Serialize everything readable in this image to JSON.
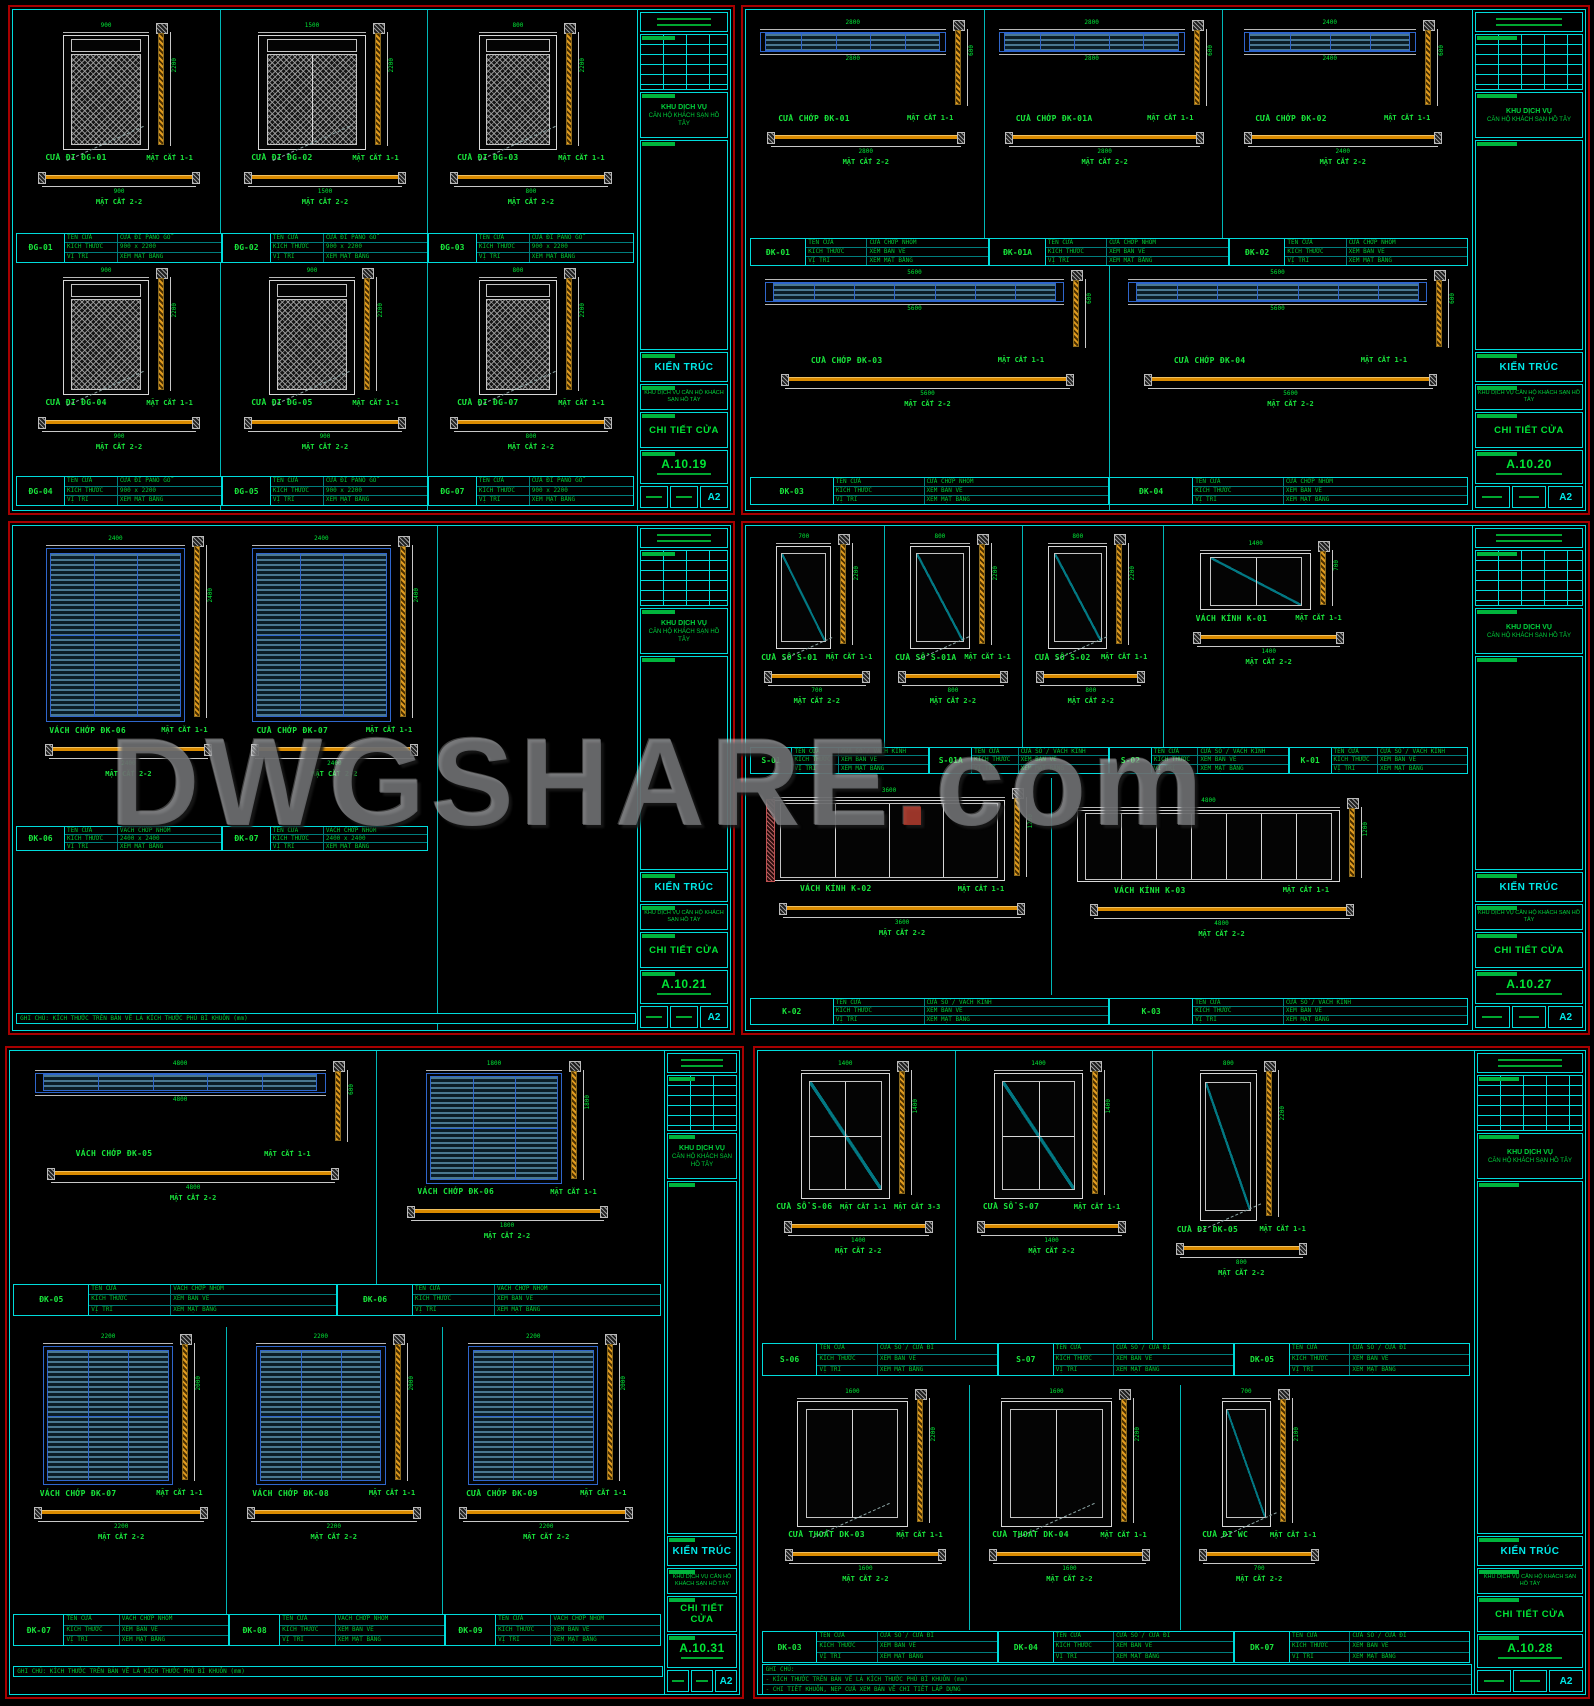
{
  "watermark": {
    "main": "DWGSHARE",
    "dot": ".",
    "tld": "com"
  },
  "labels": {
    "cut1": "MẶT CẮT 1-1",
    "cut2": "MẶT CẮT 2-2"
  },
  "sched_labels": [
    "TÊN CỬA",
    "KÍCH THƯỚC",
    "VỊ TRÍ"
  ],
  "titleblock": {
    "discipline": "KIẾN TRÚC",
    "project_l1": "KHU DỊCH VỤ",
    "project_l2": "CĂN HỘ KHÁCH SẠN HỒ TÂY",
    "project_full": "KHU DỊCH VỤ CĂN HỘ KHÁCH SẠN HỒ TÂY",
    "title": "CHI TIẾT CỬA",
    "paper": "A2"
  },
  "sheets": [
    {
      "sheet_no": "A.10.19",
      "region": {
        "x": 8,
        "y": 5,
        "w": 727,
        "h": 510,
        "tb": 92
      },
      "sched_vals": [
        "CỬA ĐI PANO GỖ",
        "900 x 2200",
        "XEM MẶT BẰNG"
      ],
      "vlines": [
        {
          "x": 33.2
        },
        {
          "x": 66.4
        }
      ],
      "groups": [
        {
          "x": 2,
          "y": 2.5,
          "w": 30,
          "h": 41,
          "kind": "door-hatch",
          "label": "CỬA ĐI ĐG-01",
          "dims": {
            "w": "900",
            "h": "2200"
          },
          "elev_w": 46,
          "draw_h": 62
        },
        {
          "x": 35,
          "y": 2.5,
          "w": 30,
          "h": 41,
          "kind": "door-hatch2",
          "label": "CỬA ĐI ĐG-02",
          "dims": {
            "w": "1500",
            "h": "2200"
          },
          "elev_w": 58,
          "draw_h": 62
        },
        {
          "x": 68,
          "y": 2.5,
          "w": 30,
          "h": 41,
          "kind": "door-hatch",
          "label": "CỬA ĐI ĐG-03",
          "dims": {
            "w": "800",
            "h": "2200"
          },
          "elev_w": 42,
          "draw_h": 62
        },
        {
          "x": 2,
          "y": 51.5,
          "w": 30,
          "h": 41,
          "kind": "door-hatch",
          "label": "CỬA ĐI ĐG-04",
          "dims": {
            "w": "900",
            "h": "2200"
          },
          "elev_w": 46,
          "draw_h": 62
        },
        {
          "x": 35,
          "y": 51.5,
          "w": 30,
          "h": 41,
          "kind": "door-hatch",
          "label": "CỬA ĐI ĐG-05",
          "dims": {
            "w": "900",
            "h": "2200"
          },
          "elev_w": 46,
          "draw_h": 62
        },
        {
          "x": 68,
          "y": 51.5,
          "w": 30,
          "h": 41,
          "kind": "door-hatch",
          "label": "CỬA ĐI ĐG-07",
          "dims": {
            "w": "800",
            "h": "2200"
          },
          "elev_w": 42,
          "draw_h": 62
        }
      ],
      "schedules": [
        {
          "x": 0.5,
          "y": 44.5,
          "w": 99,
          "h": 6,
          "tags": [
            "ĐG-01",
            "ĐG-02",
            "ĐG-03"
          ]
        },
        {
          "x": 0.5,
          "y": 93.2,
          "w": 99,
          "h": 6,
          "tags": [
            "ĐG-04",
            "ĐG-05",
            "ĐG-07"
          ]
        }
      ]
    },
    {
      "sheet_no": "A.10.20",
      "region": {
        "x": 741,
        "y": 5,
        "w": 849,
        "h": 510,
        "tb": 112
      },
      "sched_vals": [
        "CỬA CHỚP NHÔM",
        "XEM BẢN VẼ",
        "XEM MẶT BẰNG"
      ],
      "vlines": [
        {
          "x": 32.8,
          "y2": 50
        },
        {
          "x": 65.6,
          "y2": 50
        },
        {
          "x": 50,
          "y1": 50
        }
      ],
      "groups": [
        {
          "x": 0.5,
          "y": 2,
          "w": 32,
          "h": 43,
          "kind": "louvre-strip",
          "panes": 5,
          "label": "CỬA CHỚP ĐK-01",
          "dims": {
            "w": "2800",
            "h": "600"
          },
          "elev_w": 80,
          "draw_h": 42
        },
        {
          "x": 33.4,
          "y": 2,
          "w": 32,
          "h": 43,
          "kind": "louvre-strip",
          "panes": 5,
          "label": "CỬA CHỚP ĐK-01A",
          "dims": {
            "w": "2800",
            "h": "600"
          },
          "elev_w": 80,
          "draw_h": 42
        },
        {
          "x": 66.2,
          "y": 2,
          "w": 32,
          "h": 43,
          "kind": "louvre-strip",
          "panes": 4,
          "label": "CỬA CHỚP ĐK-02",
          "dims": {
            "w": "2400",
            "h": "600"
          },
          "elev_w": 74,
          "draw_h": 42
        },
        {
          "x": 1,
          "y": 52,
          "w": 48,
          "h": 41,
          "kind": "louvre-strip",
          "panes": 7,
          "label": "CỬA CHỚP ĐK-03",
          "dims": {
            "w": "5600",
            "h": "600"
          },
          "elev_w": 86,
          "draw_h": 40
        },
        {
          "x": 51,
          "y": 52,
          "w": 48,
          "h": 41,
          "kind": "louvre-strip",
          "panes": 7,
          "label": "CỬA CHỚP ĐK-04",
          "dims": {
            "w": "5600",
            "h": "600"
          },
          "elev_w": 86,
          "draw_h": 40
        }
      ],
      "schedules": [
        {
          "x": 0.5,
          "y": 45.6,
          "w": 99,
          "h": 5.6,
          "tags": [
            "ĐK-01",
            "ĐK-01A",
            "ĐK-02"
          ]
        },
        {
          "x": 0.5,
          "y": 93.4,
          "w": 99,
          "h": 5.6,
          "tags": [
            "ĐK-03",
            "ĐK-04"
          ]
        }
      ]
    },
    {
      "sheet_no": "A.10.21",
      "region": {
        "x": 8,
        "y": 521,
        "w": 727,
        "h": 514,
        "tb": 92
      },
      "sched_vals": [
        "VÁCH CHỚP NHÔM",
        "2400 x 2400",
        "XEM MẶT BẰNG"
      ],
      "vlines": [
        {
          "x": 68
        }
      ],
      "groups": [
        {
          "x": 3,
          "y": 2,
          "w": 31,
          "h": 56,
          "kind": "louvre",
          "label": "VÁCH CHỚP ĐK-06",
          "dims": {
            "w": "2400",
            "h": "2400"
          },
          "elev_w": 72,
          "draw_h": 66
        },
        {
          "x": 36,
          "y": 2,
          "w": 31,
          "h": 56,
          "kind": "louvre",
          "label": "CỬA CHỚP ĐK-07",
          "dims": {
            "w": "2400",
            "h": "2400"
          },
          "elev_w": 72,
          "draw_h": 66
        }
      ],
      "schedules": [
        {
          "x": 0.5,
          "y": 59.5,
          "w": 66,
          "h": 5,
          "tags": [
            "ĐK-06",
            "ĐK-07"
          ]
        }
      ],
      "notes": {
        "x": 0.5,
        "y": 96.6,
        "w": 99,
        "lines": [
          "GHI CHÚ: KÍCH THƯỚC TRÊN BẢN VẼ LÀ KÍCH THƯỚC PHỦ BÌ KHUÔN (mm)"
        ]
      }
    },
    {
      "sheet_no": "A.10.27",
      "region": {
        "x": 741,
        "y": 521,
        "w": 849,
        "h": 514,
        "tb": 112
      },
      "sched_vals": [
        "CỬA SỔ / VÁCH KÍNH",
        "XEM BẢN VẼ",
        "XEM MẶT BẰNG"
      ],
      "vlines": [
        {
          "x": 19,
          "y2": 44
        },
        {
          "x": 38,
          "y2": 44
        },
        {
          "x": 57.5,
          "y2": 44
        },
        {
          "x": 42,
          "y1": 50,
          "y2": 93
        }
      ],
      "groups": [
        {
          "x": 1.5,
          "y": 1.5,
          "w": 16.5,
          "h": 41,
          "kind": "door-glass",
          "label": "CỬA SỔ S-01",
          "dims": {
            "w": "700",
            "h": "2200"
          },
          "elev_w": 46,
          "draw_h": 56
        },
        {
          "x": 20,
          "y": 1.5,
          "w": 17,
          "h": 41,
          "kind": "door-glass",
          "label": "CỬA SỔ S-01A",
          "dims": {
            "w": "800",
            "h": "2200"
          },
          "elev_w": 48,
          "draw_h": 56
        },
        {
          "x": 39,
          "y": 1.5,
          "w": 17,
          "h": 41,
          "kind": "door-glass",
          "label": "CỬA SỔ S-02",
          "dims": {
            "w": "800",
            "h": "2200"
          },
          "elev_w": 48,
          "draw_h": 56
        },
        {
          "x": 60,
          "y": 3,
          "w": 24,
          "h": 38,
          "kind": "window-2pane",
          "label": "VÁCH KÍNH K-01",
          "dims": {
            "w": "1400",
            "h": "700"
          },
          "elev_w": 64,
          "draw_h": 36
        },
        {
          "x": 1.5,
          "y": 52,
          "w": 40,
          "h": 40,
          "kind": "glass-multi",
          "panes": 4,
          "endblock": true,
          "label": "VÁCH KÍNH K-02",
          "dims": {
            "w": "3600",
            "h": "1200"
          },
          "elev_w": 80,
          "draw_h": 46
        },
        {
          "x": 44,
          "y": 54,
          "w": 43,
          "h": 38,
          "kind": "glass-multi",
          "panes": 7,
          "label": "VÁCH KÍNH K-03",
          "dims": {
            "w": "4800",
            "h": "1200"
          },
          "elev_w": 84,
          "draw_h": 44
        }
      ],
      "schedules": [
        {
          "x": 0.5,
          "y": 43.8,
          "w": 99,
          "h": 5.4,
          "tags": [
            "S-01",
            "S-01A",
            "S-02",
            "K-01"
          ]
        },
        {
          "x": 0.5,
          "y": 93.6,
          "w": 99,
          "h": 5.4,
          "tags": [
            "K-02",
            "K-03"
          ]
        }
      ]
    },
    {
      "sheet_no": "A.10.31",
      "region": {
        "x": 5,
        "y": 1046,
        "w": 739,
        "h": 653,
        "tb": 74
      },
      "sched_vals": [
        "VÁCH CHỚP NHÔM",
        "XEM BẢN VẼ",
        "XEM MẶT BẰNG"
      ],
      "vlines": [
        {
          "x": 56,
          "y2": 41
        },
        {
          "x": 33,
          "y1": 43,
          "y2": 92
        },
        {
          "x": 66,
          "y1": 43,
          "y2": 92
        }
      ],
      "groups": [
        {
          "x": 1.5,
          "y": 1.5,
          "w": 53,
          "h": 33,
          "kind": "louvre-strip",
          "panes": 5,
          "label": "VÁCH CHỚP ĐK-05",
          "dims": {
            "w": "4800",
            "h": "600"
          },
          "elev_w": 84,
          "draw_h": 40
        },
        {
          "x": 58,
          "y": 1.5,
          "w": 36,
          "h": 33,
          "kind": "louvre",
          "label": "VÁCH CHỚP ĐK-06",
          "dims": {
            "w": "1800",
            "h": "1800"
          },
          "elev_w": 58,
          "draw_h": 58
        },
        {
          "x": 1.5,
          "y": 44,
          "w": 31,
          "h": 42,
          "kind": "louvre",
          "label": "VÁCH CHỚP ĐK-07",
          "dims": {
            "w": "2200",
            "h": "2000"
          },
          "elev_w": 64,
          "draw_h": 56
        },
        {
          "x": 34,
          "y": 44,
          "w": 31,
          "h": 42,
          "kind": "louvre",
          "label": "VÁCH CHỚP ĐK-08",
          "dims": {
            "w": "2200",
            "h": "2000"
          },
          "elev_w": 64,
          "draw_h": 56
        },
        {
          "x": 66.5,
          "y": 44,
          "w": 31,
          "h": 42,
          "kind": "louvre",
          "label": "CỬA CHỚP ĐK-09",
          "dims": {
            "w": "2200",
            "h": "2000"
          },
          "elev_w": 64,
          "draw_h": 56
        }
      ],
      "schedules": [
        {
          "x": 0.5,
          "y": 36.2,
          "w": 99,
          "h": 5,
          "tags": [
            "ĐK-05",
            "ĐK-06"
          ]
        },
        {
          "x": 0.5,
          "y": 87.6,
          "w": 99,
          "h": 5,
          "tags": [
            "ĐK-07",
            "ĐK-08",
            "ĐK-09"
          ]
        }
      ],
      "notes": {
        "x": 0.5,
        "y": 95.6,
        "w": 99,
        "lines": [
          "GHI CHÚ: KÍCH THƯỚC TRÊN BẢN VẼ LÀ KÍCH THƯỚC PHỦ BÌ KHUÔN (mm)"
        ]
      }
    },
    {
      "sheet_no": "A.10.28",
      "region": {
        "x": 753,
        "y": 1046,
        "w": 837,
        "h": 653,
        "tb": 110
      },
      "sched_vals": [
        "CỬA SỔ / CỬA ĐI",
        "XEM BẢN VẼ",
        "XEM MẶT BẰNG"
      ],
      "vlines": [
        {
          "x": 27.5,
          "y2": 45
        },
        {
          "x": 55,
          "y2": 45
        },
        {
          "x": 29.5,
          "y1": 52,
          "y2": 90
        },
        {
          "x": 59,
          "y1": 52,
          "y2": 90
        }
      ],
      "groups": [
        {
          "x": 2,
          "y": 1.5,
          "w": 24,
          "h": 43,
          "kind": "window-4pane",
          "label": "CỬA SỔ S-06",
          "cut3": "MẶT CẮT 3-3",
          "dims": {
            "w": "1400",
            "h": "1400"
          },
          "elev_w": 52,
          "draw_h": 50
        },
        {
          "x": 29,
          "y": 1.5,
          "w": 24,
          "h": 43,
          "kind": "window-4pane",
          "label": "CỬA SỔ S-07",
          "dims": {
            "w": "1400",
            "h": "1400"
          },
          "elev_w": 52,
          "draw_h": 50
        },
        {
          "x": 57,
          "y": 1.5,
          "w": 21,
          "h": 43,
          "kind": "door-glass",
          "label": "CỬA ĐI DK-05",
          "dims": {
            "w": "800",
            "h": "2200"
          },
          "elev_w": 38,
          "draw_h": 58
        },
        {
          "x": 2,
          "y": 52.5,
          "w": 26,
          "h": 37,
          "kind": "door-2leaf",
          "label": "CỬA THOÁT DK-03",
          "dims": {
            "w": "1600",
            "h": "2200"
          },
          "elev_w": 60,
          "draw_h": 58
        },
        {
          "x": 30.5,
          "y": 52.5,
          "w": 26,
          "h": 37,
          "kind": "door-2leaf",
          "label": "CỬA THOÁT DK-04",
          "dims": {
            "w": "1600",
            "h": "2200"
          },
          "elev_w": 60,
          "draw_h": 58
        },
        {
          "x": 60.5,
          "y": 52.5,
          "w": 19,
          "h": 37,
          "kind": "door-glass",
          "label": "CỬA ĐI WC",
          "dims": {
            "w": "700",
            "h": "2100"
          },
          "elev_w": 36,
          "draw_h": 58
        }
      ],
      "schedules": [
        {
          "x": 0.5,
          "y": 45.4,
          "w": 99,
          "h": 5.2,
          "tags": [
            "S-06",
            "S-07",
            "DK-05"
          ]
        },
        {
          "x": 0.5,
          "y": 90.2,
          "w": 99,
          "h": 5,
          "tags": [
            "DK-03",
            "DK-04",
            "DK-07"
          ]
        }
      ],
      "notes": {
        "x": 0.5,
        "y": 95.4,
        "w": 99,
        "lines": [
          "GHI CHÚ:",
          "- KÍCH THƯỚC TRÊN BẢN VẼ LÀ KÍCH THƯỚC PHỦ BÌ KHUÔN (mm)",
          "- CHI TIẾT KHUÔN, NẸP CỬA XEM BẢN VẼ CHI TIẾT LẮP DỰNG"
        ]
      }
    }
  ]
}
